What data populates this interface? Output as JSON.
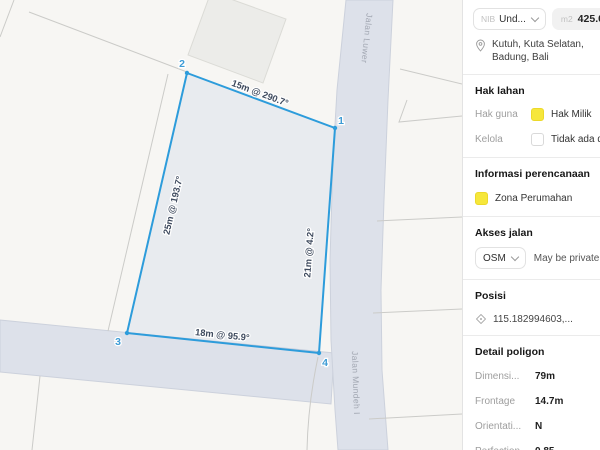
{
  "sidebar": {
    "parcel": {
      "prefix": "NIB",
      "value": "Und..."
    },
    "area": {
      "unit": "m2",
      "value": "425.0"
    },
    "location": "Kutuh, Kuta Selatan, Badung, Bali",
    "hak_lahan": {
      "title": "Hak lahan",
      "rows": [
        {
          "label": "Hak guna",
          "value": "Hak Milik",
          "swatch": "yellow"
        },
        {
          "label": "Kelola",
          "value": "Tidak ada data",
          "swatch": "empty"
        }
      ]
    },
    "perencanaan": {
      "title": "Informasi perencanaan",
      "zone": "Zona Perumahan"
    },
    "akses_jalan": {
      "title": "Akses jalan",
      "source": "OSM",
      "note": "May be private"
    },
    "posisi": {
      "title": "Posisi",
      "coords": "115.182994603,..."
    },
    "detail": {
      "title": "Detail poligon",
      "rows": [
        {
          "label": "Dimensi...",
          "value": "79m"
        },
        {
          "label": "Frontage",
          "value": "14.7m"
        },
        {
          "label": "Orientati...",
          "value": "N"
        },
        {
          "label": "Perfection",
          "value": "0.85"
        }
      ]
    },
    "colors": {
      "zone_yellow": "#F6E73B",
      "polygon_blue": "#2D9CDB",
      "road_fill": "#dde1ea"
    }
  },
  "map": {
    "vertex_labels": {
      "v1": "1",
      "v2": "2",
      "v3": "3",
      "v4": "4"
    },
    "edges": {
      "top": "15m @ 290.7°",
      "left": "25m @ 193.7°",
      "right": "21m @ 4.2°",
      "bottom": "18m @ 95.9°"
    },
    "roads": {
      "vertical": "Jalan Luwer",
      "bottom": "Jalan Mundeh I"
    }
  }
}
